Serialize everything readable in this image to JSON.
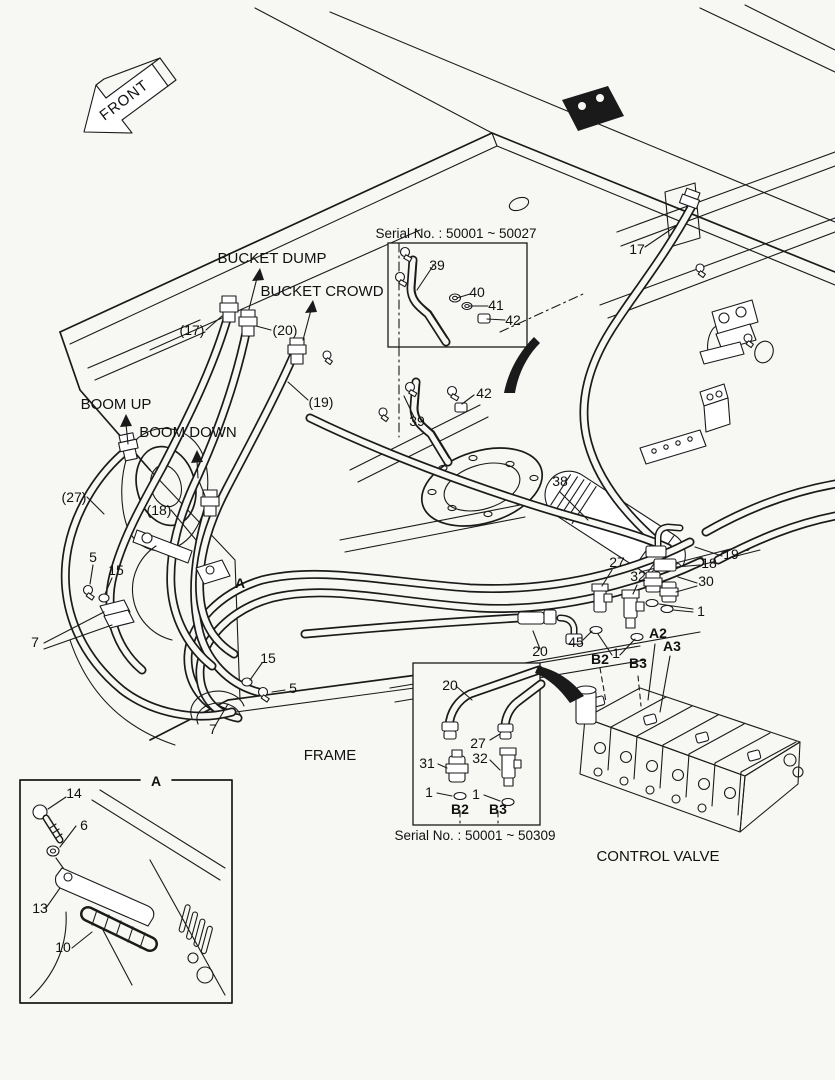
{
  "colors": {
    "background": "#f7f7f4",
    "ink": "#1a1a1a"
  },
  "labels": {
    "front": "FRONT",
    "serial_top": "Serial No. : 50001 ~ 50027",
    "serial_bottom": "Serial No. : 50001 ~ 50309",
    "bucket_dump": "BUCKET DUMP",
    "bucket_crowd": "BUCKET CROWD",
    "boom_up": "BOOM UP",
    "boom_down": "BOOM DOWN",
    "frame": "FRAME",
    "control_valve": "CONTROL VALVE"
  },
  "parts": {
    "t39": "39",
    "t40": "40",
    "t41": "41",
    "t42": "42",
    "p17": "(17)",
    "p20": "(20)",
    "p19": "(19)",
    "p27": "(27)",
    "p18": "(18)",
    "m5a": "5",
    "m15a": "15",
    "m7a": "7",
    "mA": "A",
    "m39": "39",
    "m42": "42",
    "m38": "38",
    "m17": "17",
    "m15b": "15",
    "m5b": "5",
    "m7b": "7",
    "r27": "27",
    "r32": "32",
    "r18": "18",
    "r19": "19",
    "r30": "30",
    "r1a": "1",
    "r45": "45",
    "r1b": "1",
    "rB2": "B2",
    "rB3": "B3",
    "rA2": "A2",
    "rA3": "A3",
    "m20": "20",
    "c20": "20",
    "c27": "27",
    "c31": "31",
    "c32": "32",
    "c1a": "1",
    "c1b": "1",
    "cB2": "B2",
    "cB3": "B3",
    "dA": "A",
    "d14": "14",
    "d6": "6",
    "d13": "13",
    "d10": "10"
  }
}
